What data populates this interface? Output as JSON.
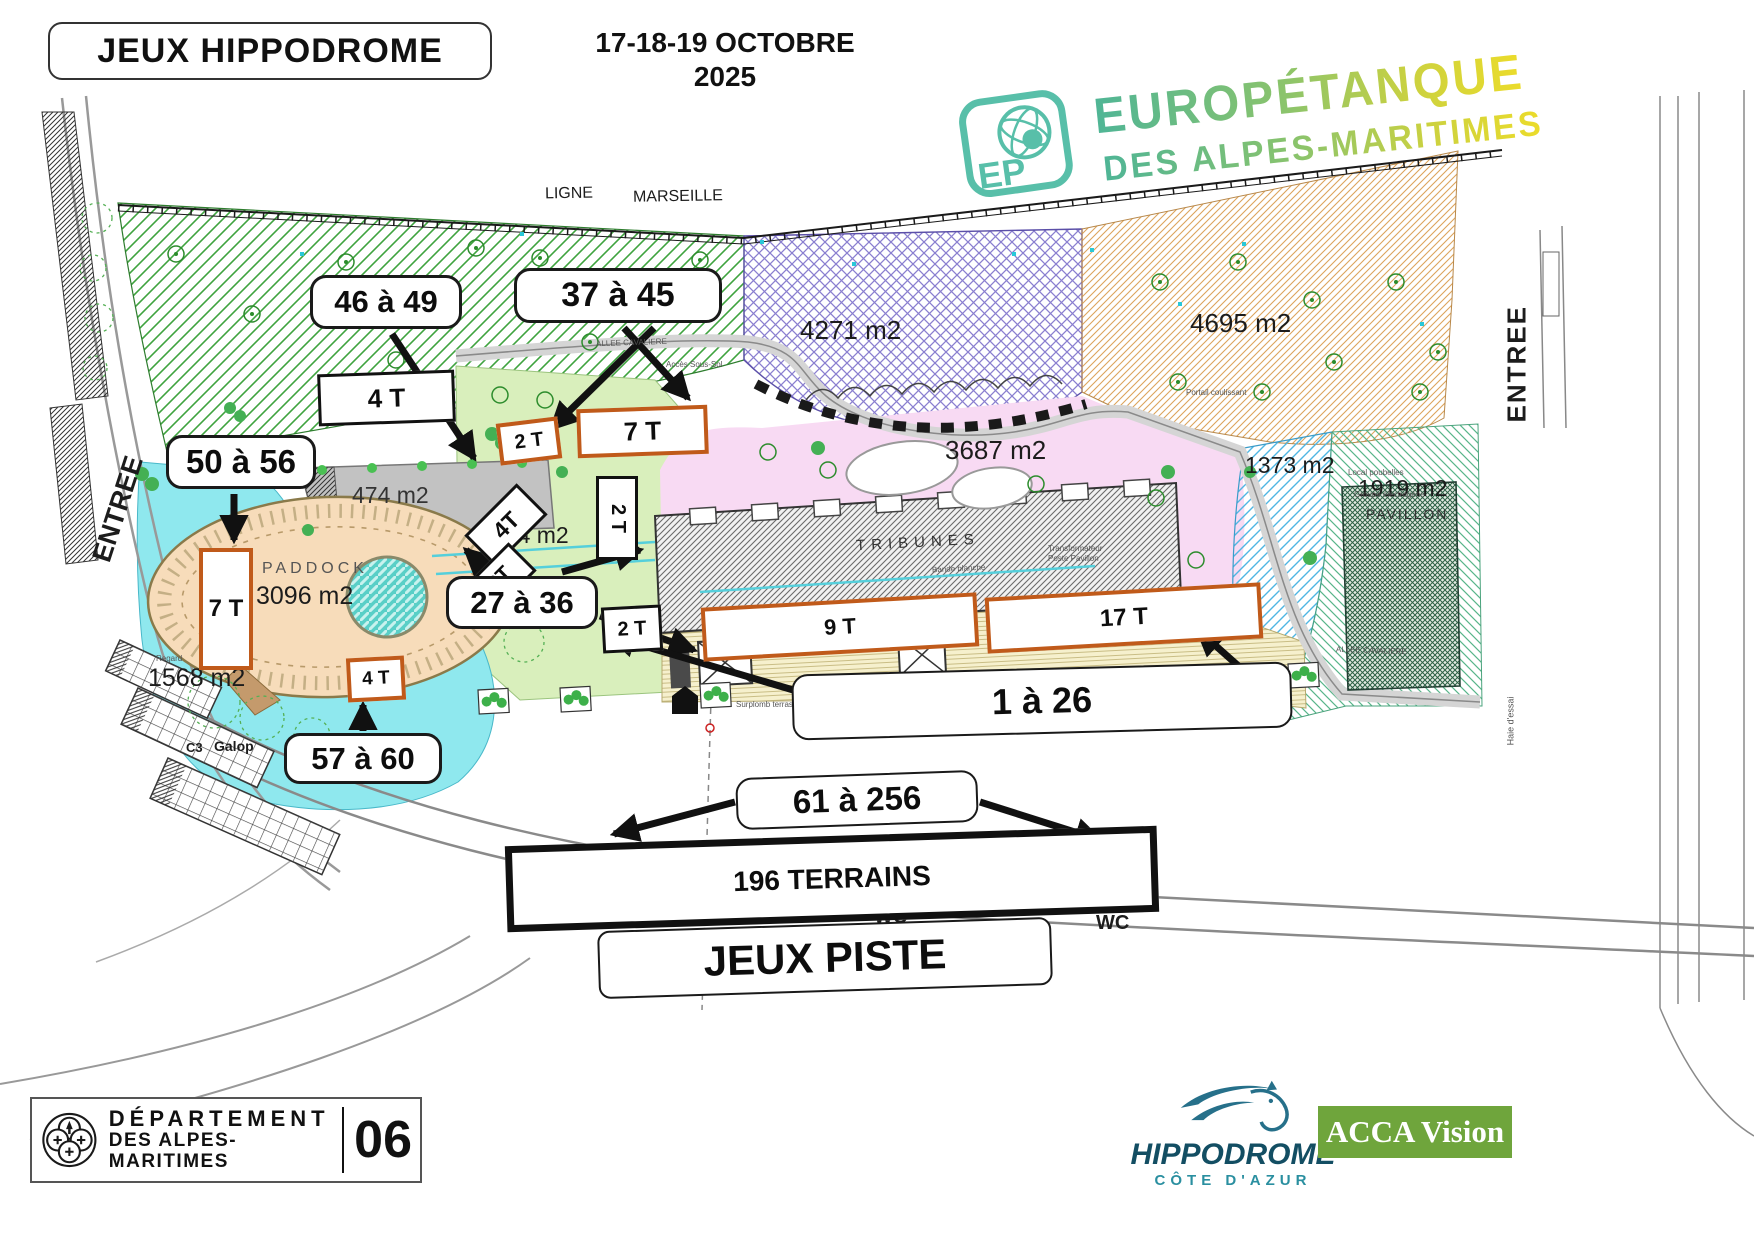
{
  "header": {
    "title": "JEUX HIPPODROME",
    "date_line1": "17-18-19 OCTOBRE",
    "date_line2": "2025"
  },
  "logo": {
    "ep": "EP",
    "line1": "EUROPÉTANQUE",
    "line2": "DES ALPES-MARITIMES"
  },
  "map": {
    "railway_label_1": "LIGNE",
    "railway_label_2": "MARSEILLE",
    "entree_left": "ENTREE",
    "entree_right": "ENTREE",
    "areas": {
      "a4271": "4271 m2",
      "a4695": "4695 m2",
      "a3687": "3687 m2",
      "a1373": "1373 m2",
      "a1919": "1919 m2",
      "pavillon": "PAVILLON",
      "a474": "474 m2",
      "a564": "564 m2",
      "paddock": "PADDOCK",
      "a3096": "3096 m2",
      "a1568": "1568 m2",
      "c3": "C3",
      "galop": "Galop",
      "tribunes": "TRIBUNES"
    },
    "callouts": {
      "c46": "46 à 49",
      "c37": "37 à 45",
      "c50": "50 à 56",
      "c27": "27 à 36",
      "c57": "57 à 60",
      "c1": "1 à 26",
      "c61": "61 à 256",
      "piste": "JEUX PISTE"
    },
    "terrain_boxes": {
      "t4a": "4 T",
      "t2b": "2 T",
      "t7c": "7 T",
      "t4d": "4T",
      "t2e": "2T",
      "t2f": "2 T",
      "t2g": "2 T",
      "t7h": "7 T",
      "t4i": "4 T",
      "t9": "9 T",
      "t17": "17 T",
      "t196": "196 TERRAINS"
    },
    "wc": "WC",
    "r": "R",
    "tiny": {
      "allee1": "ALLEE CAVALIERE",
      "acces": "Accès Sous-Sol",
      "allee2": "ALLEE CAVALIERE",
      "bande": "Bande blanche",
      "surplomb": "Surplomb terrasse",
      "haie": "Haie d'essai",
      "transfo1": "Transformateur",
      "transfo2": "Poste Pavillon",
      "local": "Local poubelles",
      "groupe": "Groupe électrogène",
      "portail": "Portail coulissant",
      "regard": "Regard"
    }
  },
  "footer": {
    "dept1": "DÉPARTEMENT",
    "dept2": "DES ALPES-MARITIMES",
    "dept_num": "06",
    "hippo": "HIPPODROME",
    "cote": "CÔTE D'AZUR",
    "acca": "ACCA Vision"
  },
  "colors": {
    "terrain_border": "#c05a1a",
    "logo_teal": "#58bfa9",
    "acca_green": "#6fa53c",
    "hippo_blue": "#1d5f78"
  }
}
